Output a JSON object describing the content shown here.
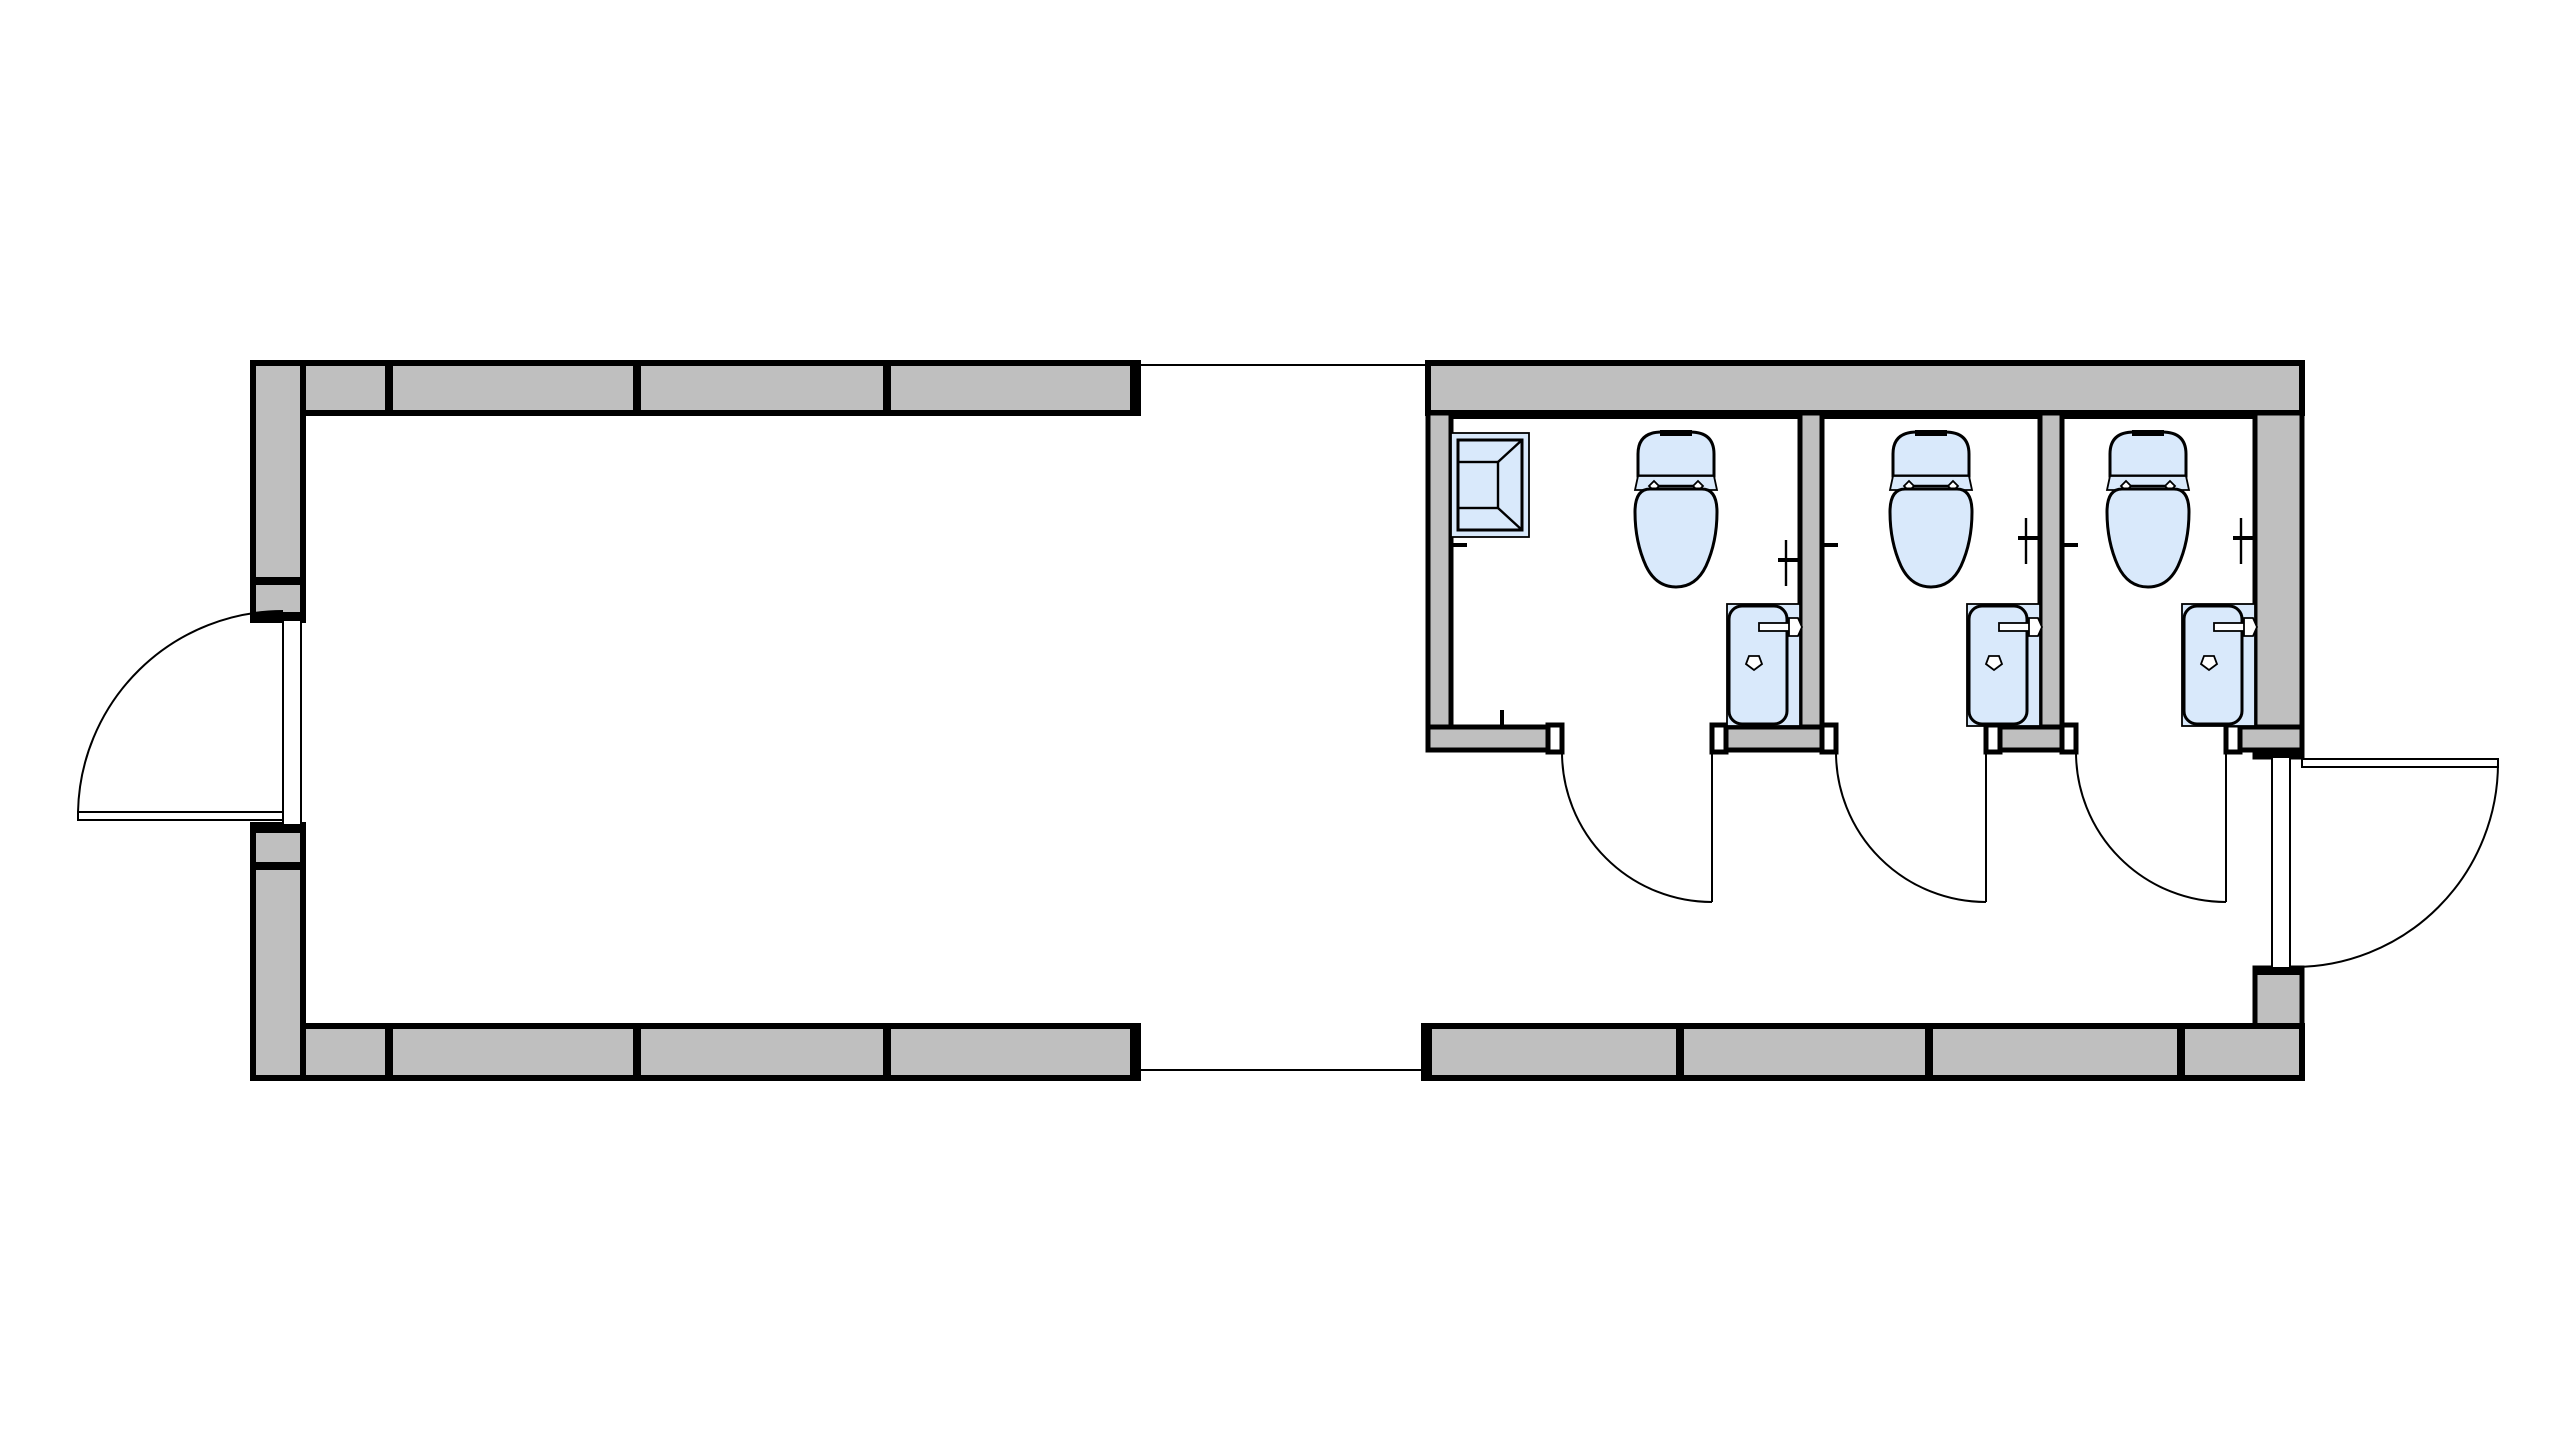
{
  "colors": {
    "wall_fill": "#bfbfbf",
    "wall_outline": "#000000",
    "fixture_fill": "#d9e9fb",
    "fixture_outline": "#000000",
    "floor_line": "#000000",
    "page_bg": "#ffffff"
  },
  "plan": {
    "type": "architectural-floor-plan",
    "drawing_style": "2D plan view, gray panelized walls with black outlines, light-blue plumbing fixtures, quarter-circle door swings",
    "sections": [
      {
        "name": "open-room",
        "position": "left",
        "walls": "north, west, south (panelized with joints); east side open to breezeway",
        "doors": [
          {
            "name": "west-entry-door",
            "swing": "outward to the west, hinged at south jamb"
          }
        ]
      },
      {
        "name": "breezeway",
        "position": "center",
        "walls": "none; thin floor slab edge lines top and bottom"
      },
      {
        "name": "restroom-block",
        "position": "right",
        "stalls": [
          {
            "name": "stall-1",
            "fixtures": [
              "mop-sink",
              "toilet",
              "lavatory",
              "toilet-paper-holder",
              "wall-hook",
              "door-stop"
            ],
            "door": "outward swing, hinged at east jamb"
          },
          {
            "name": "stall-2",
            "fixtures": [
              "toilet",
              "lavatory",
              "toilet-paper-holder",
              "wall-hook"
            ],
            "door": "outward swing, hinged at east jamb"
          },
          {
            "name": "stall-3",
            "fixtures": [
              "toilet",
              "lavatory",
              "toilet-paper-holder",
              "wall-hook"
            ],
            "door": "outward swing, hinged at east jamb"
          }
        ],
        "doors": [
          {
            "name": "east-entry-door",
            "swing": "outward to the east, hinged at north jamb"
          }
        ]
      }
    ],
    "fixture_counts": {
      "toilets": 3,
      "lavatories": 3,
      "mop_sinks": 1,
      "stall_doors": 3,
      "entry_doors": 2
    }
  }
}
